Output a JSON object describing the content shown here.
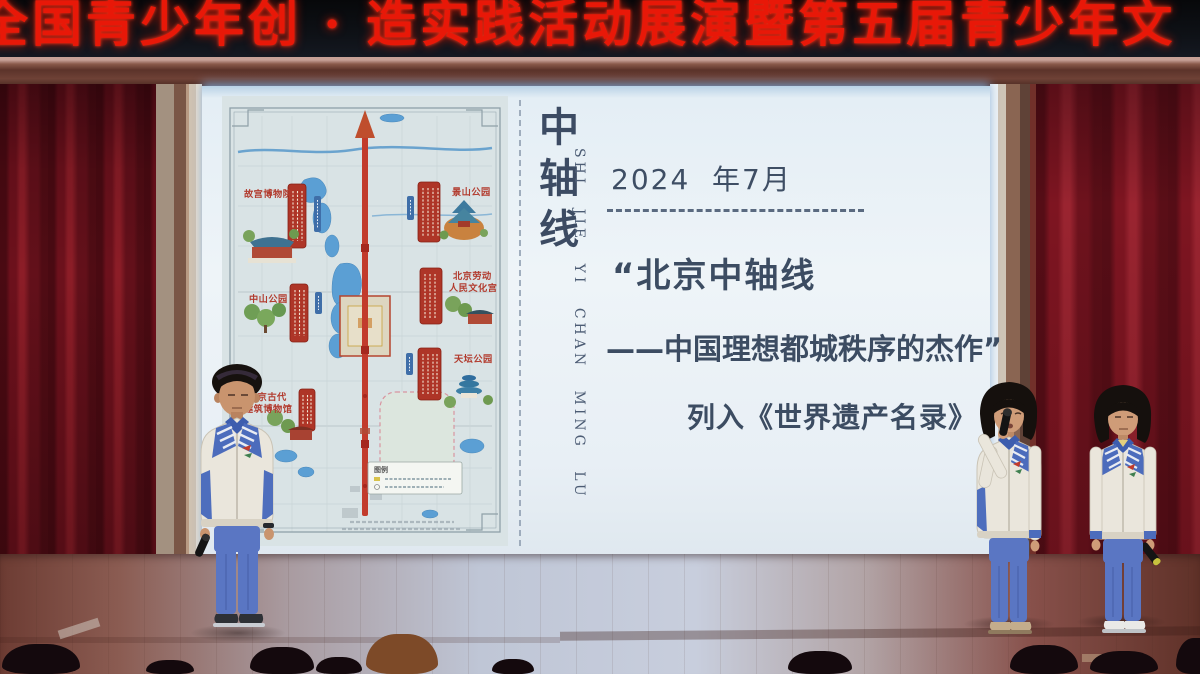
{
  "banner": {
    "text": "全国青少年创 · 造实践活动展演暨第五届青少年文",
    "color": "#e81808"
  },
  "slide": {
    "vertical_title": "中轴线",
    "vertical_pinyin": "SHI JIE YI CHAN MING LU",
    "date": "2024  年7月",
    "quote_line_1": "“北京中轴线",
    "quote_line_2": "——中国理想都城秩序的杰作”",
    "result_line": "列入《世界遗产名录》",
    "text_color": "#3d4c63"
  },
  "map": {
    "labels": {
      "palace_museum": "故宫博物院",
      "jingshan_park": "景山公园",
      "zhongshan_park": "中山公园",
      "working_peoples_palace_1": "北京劳动",
      "working_peoples_palace_2": "人民文化宫",
      "temple_of_heaven_park": "天坛公园",
      "ancient_architecture_museum_1": "北京古代",
      "ancient_architecture_museum_2": "建筑博物馆",
      "legend_title": "图例"
    },
    "label_color": "#b23b2e",
    "axis_color": "#c23b2c"
  },
  "scene": {
    "students_count": 3,
    "curtain_color": "#7c1420"
  }
}
